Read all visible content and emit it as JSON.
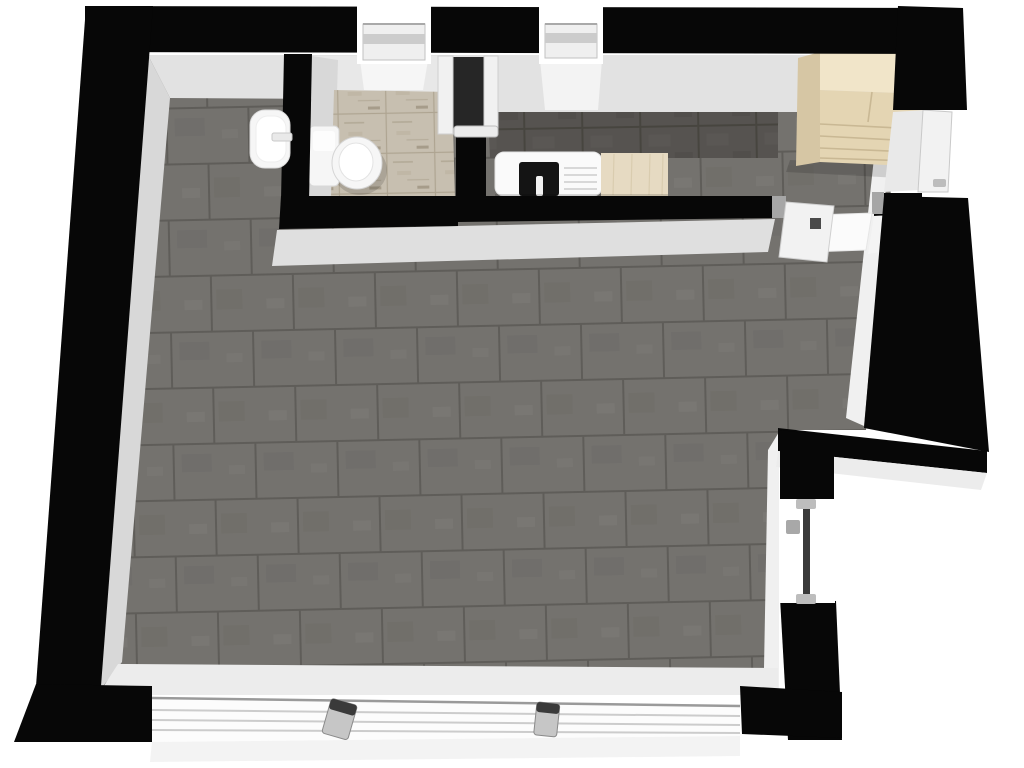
{
  "meta": {
    "title": "3D floor plan - studio apartment (top-down render)",
    "view": "top-down-3d",
    "background": "#ffffff"
  },
  "colors": {
    "wall": "#070707",
    "faceLight": "#e2e2e2",
    "faceBright": "#f0f0f0",
    "faceMid": "#d8d8d8",
    "floorTile": "#74726e",
    "floorTileAlt": "#6d6b67",
    "floorGrout": "#5f5d59",
    "bathTile": "#c7bfb0",
    "bathTileAlt": "#beb5a4",
    "bathGrout": "#a89e8a",
    "backsplashTile": "#565350",
    "backsplashGrout": "#47453f",
    "counterWhite": "#fafafa",
    "counterWood": "#e6dac2",
    "woodGrain": "#d7c9ab",
    "sinkBasin": "#141414",
    "wardrobeTop": "#f1e5c9",
    "wardrobeFront": "#e4d5b3",
    "wardrobeSide": "#d6c6a4",
    "wardrobeLine": "#c9b894",
    "fixtureWhite": "#f6f6f6",
    "fixtureStroke": "#d6d6d6",
    "doorLeaf": "#f2f2f2",
    "doorFrame": "#a6a6a6",
    "glazing": "#3a3a3a",
    "glassLine": "#cccccc",
    "handleDark": "#4a4a4a",
    "handleMetal": "#bdbdbd",
    "thresholdWhite": "#fbfbfb",
    "windowGapDark": "#262626",
    "shadow": "rgba(0,0,0,0.14)"
  },
  "rooms": [
    {
      "id": "main-room",
      "floor": "dark-grey-tile"
    },
    {
      "id": "bathroom",
      "floor": "travertine-tile"
    },
    {
      "id": "kitchen-niche",
      "floor": "dark-grey-tile"
    },
    {
      "id": "entry-hall",
      "floor": "dark-grey-tile"
    }
  ],
  "fixtures": [
    {
      "id": "toilet",
      "room": "bathroom"
    },
    {
      "id": "wall-basin",
      "room": "main-room"
    },
    {
      "id": "kitchen-counter-sink",
      "room": "kitchen-niche"
    },
    {
      "id": "kitchen-counter-wood",
      "room": "kitchen-niche"
    },
    {
      "id": "wardrobe",
      "room": "entry-hall"
    }
  ],
  "openings": [
    {
      "id": "window-top-left",
      "wall": "north"
    },
    {
      "id": "window-top-right",
      "wall": "north"
    },
    {
      "id": "bathroom-door",
      "wall": "bathroom-east"
    },
    {
      "id": "entry-door",
      "wall": "east"
    },
    {
      "id": "hall-door",
      "wall": "interior"
    },
    {
      "id": "window-right",
      "wall": "east-lower"
    },
    {
      "id": "window-south-band",
      "wall": "south"
    }
  ]
}
